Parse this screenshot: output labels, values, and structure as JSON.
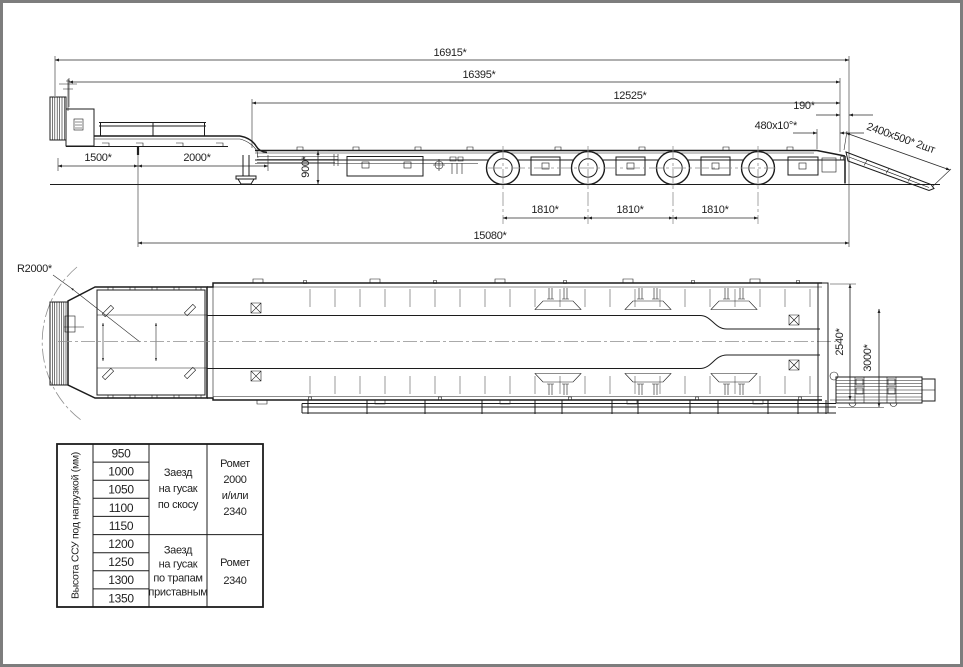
{
  "side_view": {
    "dims": {
      "overall_length": "16915*",
      "length_over_body": "16395*",
      "deck_length": "12525*",
      "rear_offset": "190*",
      "rear_bevel": "480x10°*",
      "ramp_size": "2400x500* 2шт",
      "front_overhang": "1500*",
      "gooseneck_length": "2000*",
      "deck_height": "900*",
      "axle_spacing_1": "1810*",
      "axle_spacing_2": "1810*",
      "axle_spacing_3": "1810*",
      "kingpin_to_rear": "15080*"
    }
  },
  "top_view": {
    "dims": {
      "turning_radius": "R2000*",
      "deck_width": "2540*",
      "overall_width": "3000*"
    }
  },
  "table": {
    "row_header": "Высота ССУ под нагрузкой (мм)",
    "heights": [
      "950",
      "1000",
      "1050",
      "1100",
      "1150",
      "1200",
      "1250",
      "1300",
      "1350"
    ],
    "groups": [
      {
        "method": [
          "Заезд",
          "на гусак",
          "по скосу"
        ],
        "ramps": [
          "Ромет",
          "2000",
          "и/или",
          "2340"
        ]
      },
      {
        "method": [
          "Заезд",
          "на гусак",
          "по трапам",
          "приставным"
        ],
        "ramps": [
          "Ромет",
          "2340"
        ]
      }
    ]
  }
}
